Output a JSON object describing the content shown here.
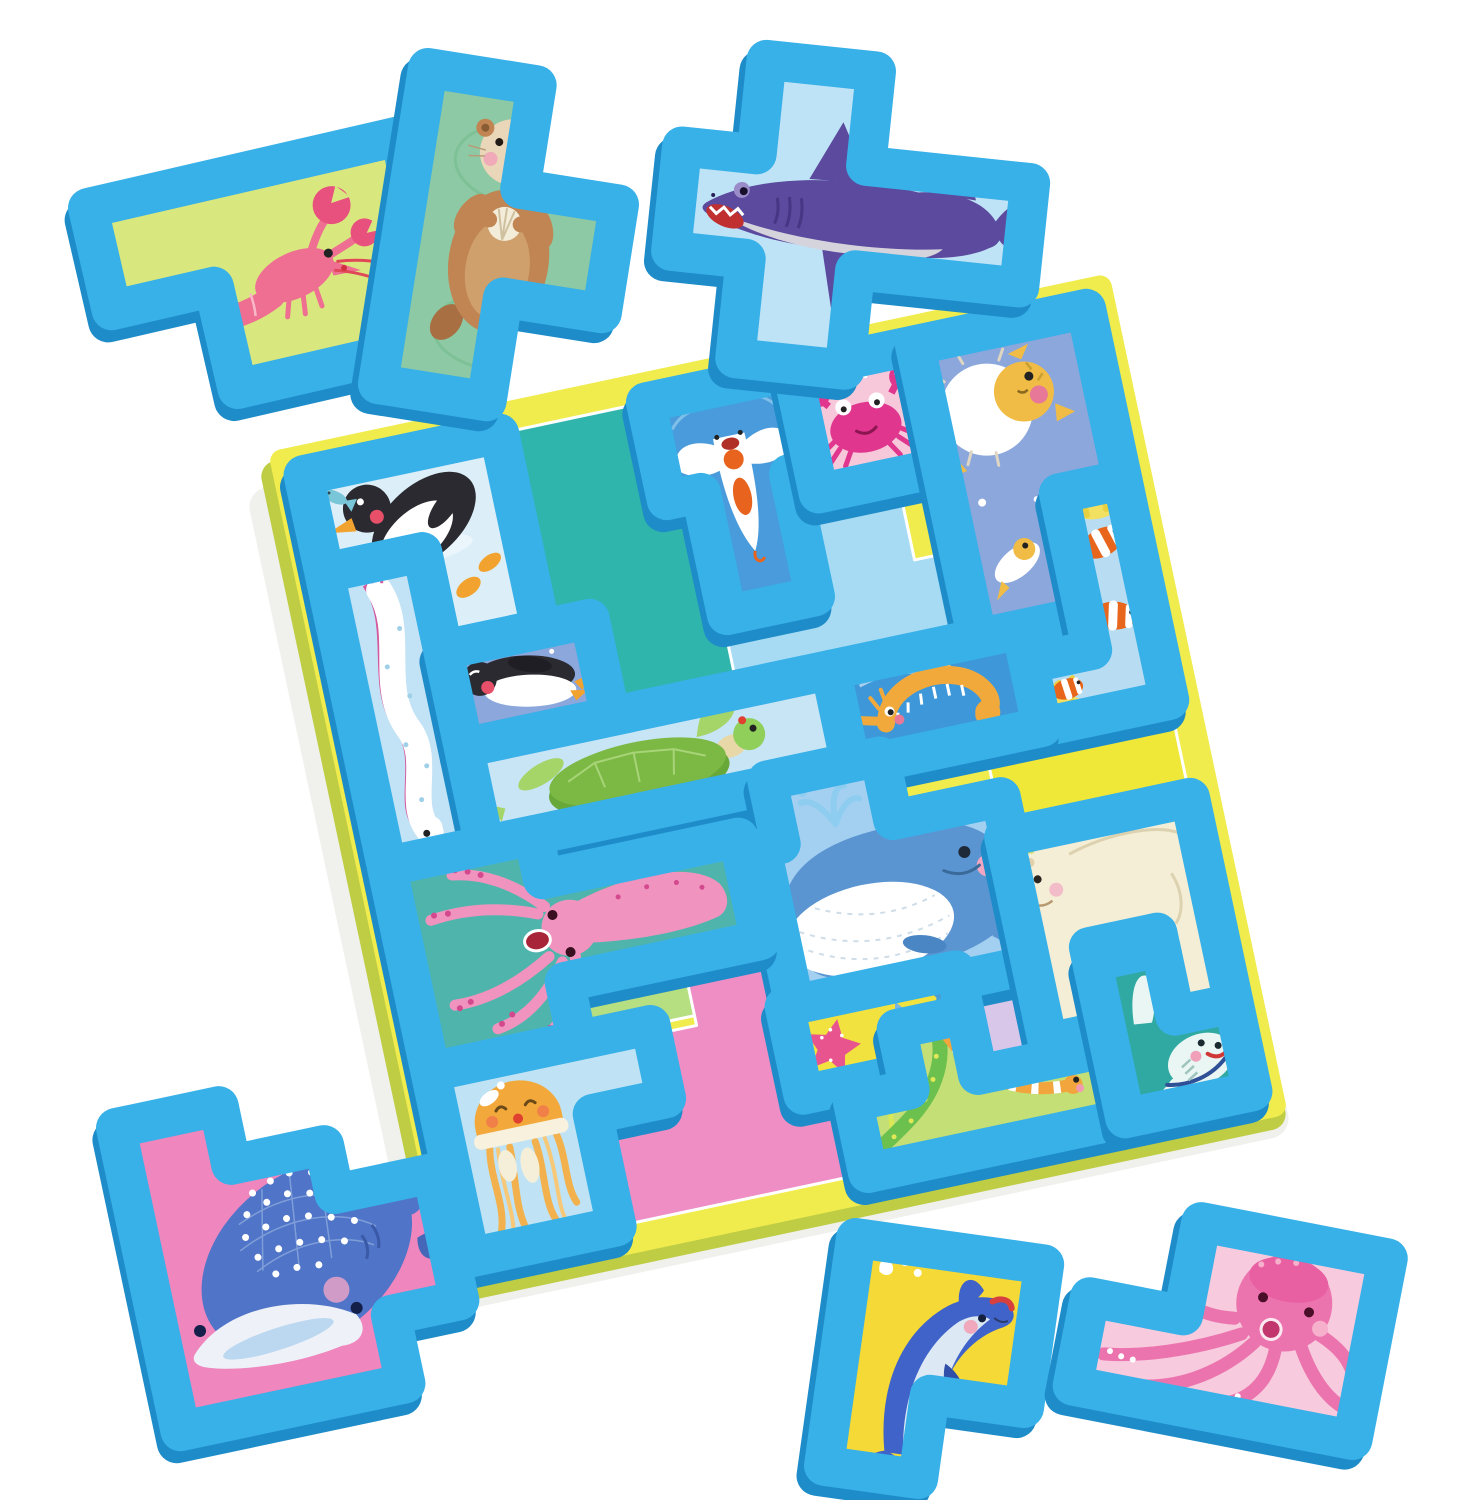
{
  "scene": {
    "background": "#ffffff",
    "subject": "sea-animal foam block tangram puzzle"
  },
  "colors": {
    "foam": "#38b0e8",
    "foam_side": "#1e8cc8",
    "board_top": "#f0ec4d",
    "board_side": "#becd44",
    "region_outline": "#ffffff"
  },
  "board": {
    "regions": [
      {
        "name": "teal",
        "color": "#2fb5ab"
      },
      {
        "name": "sky-cross",
        "color": "#a6dbf3"
      },
      {
        "name": "green",
        "color": "#b5df80"
      },
      {
        "name": "yellow",
        "color": "#f0e838"
      },
      {
        "name": "pink",
        "color": "#ee8ec5"
      },
      {
        "name": "lavender",
        "color": "#d9c7ea"
      }
    ]
  },
  "pieces": {
    "penguin_standing": {
      "label": "standing penguin with fish",
      "bg": "#dceef8",
      "main": "#2a2a30"
    },
    "oarfish": {
      "label": "oarfish",
      "bg": "#c2e2f5",
      "main": "#ffffff"
    },
    "sea_angel": {
      "label": "sea angel clione",
      "bg": "#4a9bdb",
      "main": "#ffffff"
    },
    "crab": {
      "label": "crab",
      "bg": "#f7c8da",
      "main": "#e0368e"
    },
    "pufferfish": {
      "label": "pufferfish pair",
      "bg": "#8ba7dc",
      "main": "#f0bc45"
    },
    "clownfish": {
      "label": "clownfish trio",
      "bg": "#b8ddf2",
      "main": "#e8651c"
    },
    "seahorse": {
      "label": "seahorse",
      "bg": "#3e97d8",
      "main": "#f2a93b"
    },
    "penguin_swimming": {
      "label": "swimming penguin",
      "bg": "#8ba7dc",
      "main": "#2a2a30"
    },
    "sea_turtle": {
      "label": "sea turtle",
      "bg": "#c8e5f6",
      "main": "#7cb944"
    },
    "whale": {
      "label": "blue whale with spout",
      "bg": "#a3d0f1",
      "main": "#5a95d2"
    },
    "squid": {
      "label": "squid",
      "bg": "#4fb5ac",
      "main": "#f093be"
    },
    "jellyfish": {
      "label": "jellyfish",
      "bg": "#bfe3f4",
      "main": "#f3a83c"
    },
    "starfish": {
      "label": "starfish trio",
      "bg": "#f2e240",
      "main": "#e8558e"
    },
    "polar_bear": {
      "label": "polar bear",
      "bg": "#cde170",
      "main": "#f4eed6"
    },
    "sea_snakes": {
      "label": "sea snake and eel",
      "bg": "#c4df75",
      "main": "#6cc04e"
    },
    "manta_ray": {
      "label": "white reef shark",
      "bg": "#2fa9a2",
      "main": "#e9f6f3"
    },
    "lobster": {
      "label": "lobster",
      "bg": "#d9e87e",
      "main": "#ef6f92"
    },
    "sea_otter": {
      "label": "sea otter with shell",
      "bg": "#8cc9a4",
      "main": "#c08552"
    },
    "shark": {
      "label": "shark",
      "bg": "#bfe3f6",
      "main": "#5b4a9e"
    },
    "whale_shark": {
      "label": "whale shark",
      "bg": "#ef86bd",
      "main": "#4f74c8"
    },
    "dolphin": {
      "label": "dolphin",
      "bg": "#f5d937",
      "main": "#3f63c8"
    },
    "octopus": {
      "label": "octopus",
      "bg": "#f7cadd",
      "main": "#ec74ae"
    }
  }
}
